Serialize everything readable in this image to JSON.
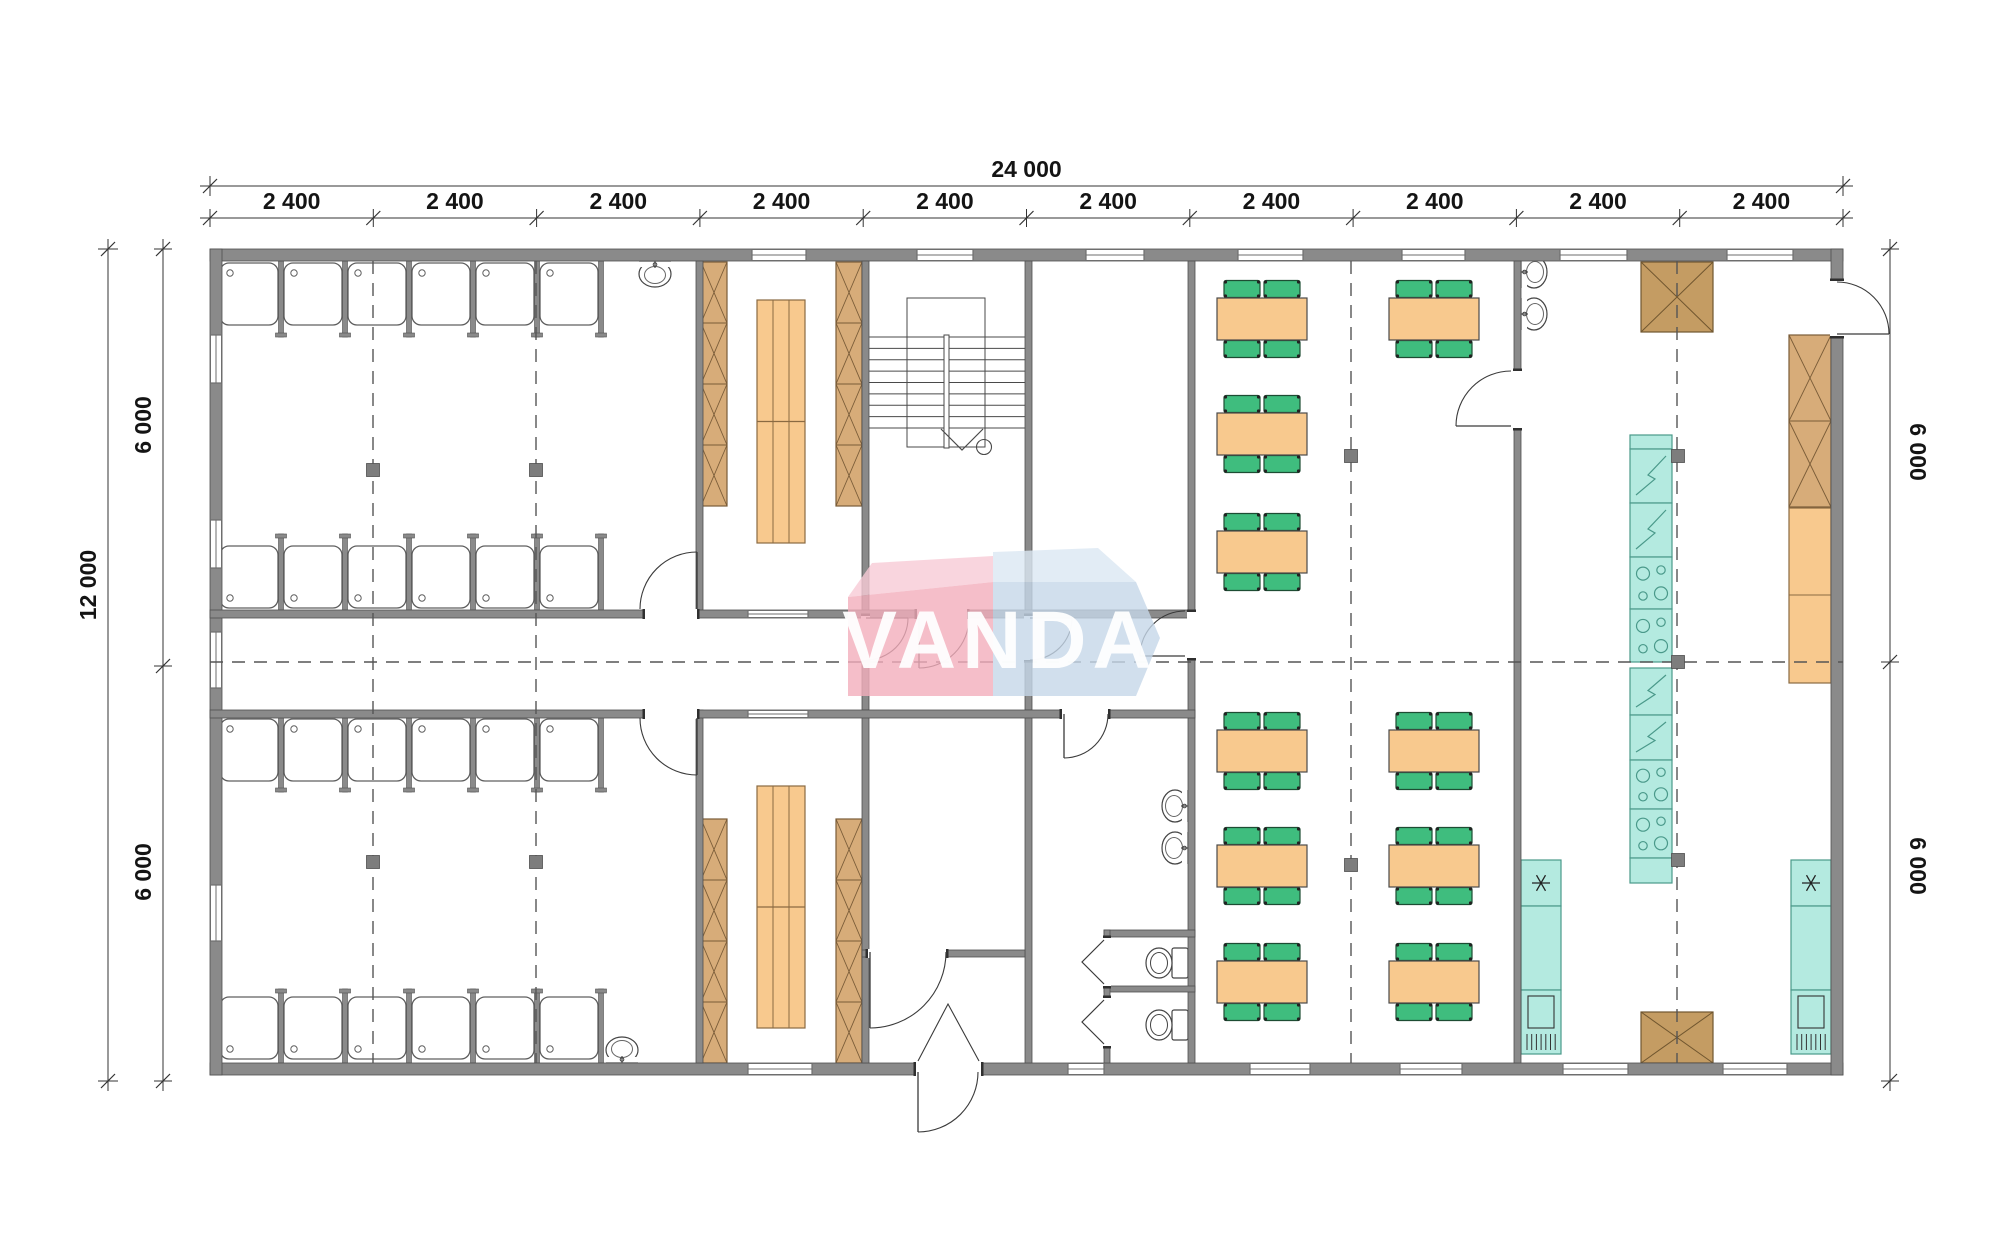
{
  "watermark": {
    "text": "VANDA",
    "pink": "#F2AEBC",
    "pinkFlap": "#F8CBD6",
    "blue": "#C5D7E8",
    "blueFlap": "#DBE7F3",
    "letters": "#FFFFFF"
  },
  "colors": {
    "wall": "#8a8a8a",
    "wallEdge": "#4f4f4f",
    "line": "#3c3c3c",
    "wood": "#D7AC79",
    "woodDark": "#7a5c38",
    "tan": "#C49C63",
    "tanDark": "#70562f",
    "orange": "#F8C98E",
    "orangeEdge": "#8a6a42",
    "green": "#3FBD7E",
    "greenEdge": "#1d4d33",
    "teal": "#B4EAE0",
    "tealEdge": "#4a998a",
    "dash": "#555555",
    "fixture": "#444444",
    "marker": "#7d7d7d",
    "dimText": "#141414",
    "dimLine": "#333333"
  },
  "dims": {
    "top": {
      "total": "24 000",
      "segments": [
        "2 400",
        "2 400",
        "2 400",
        "2 400",
        "2 400",
        "2 400",
        "2 400",
        "2 400",
        "2 400",
        "2 400"
      ],
      "lineY": 186,
      "segY": 218,
      "x0": 210,
      "x1": 1843,
      "totalLabelY": 177,
      "segLabelY": 209
    },
    "left": {
      "total": "12 000",
      "segments": [
        "6 000",
        "6 000"
      ],
      "totalX": 108,
      "segX": 163,
      "y0": 249,
      "y1": 1081,
      "mid": 666,
      "totalLabel": [
        96,
        585
      ],
      "segLabels": [
        [
          151,
          425
        ],
        [
          151,
          872
        ]
      ]
    },
    "right": {
      "segments": [
        "6 000",
        "6 000"
      ],
      "x": 1890,
      "y0": 249,
      "y1": 1081,
      "mid": 662,
      "segLabels": [
        [
          1910,
          452
        ],
        [
          1910,
          866
        ]
      ]
    }
  },
  "plan": {
    "outer": [
      210,
      249,
      1633,
      826
    ],
    "walls": [
      [
        210,
        249,
        1633,
        12
      ],
      [
        210,
        1063,
        1633,
        12
      ],
      [
        210,
        249,
        12,
        826
      ],
      [
        1831,
        249,
        12,
        826
      ],
      [
        696,
        261,
        7,
        349
      ],
      [
        696,
        710,
        7,
        353
      ],
      [
        862,
        261,
        7,
        349
      ],
      [
        862,
        610,
        7,
        100
      ],
      [
        862,
        710,
        7,
        353
      ],
      [
        1025,
        261,
        7,
        349
      ],
      [
        1025,
        610,
        7,
        100
      ],
      [
        1025,
        710,
        7,
        353
      ],
      [
        1188,
        261,
        7,
        802
      ],
      [
        1514,
        261,
        7,
        802
      ],
      [
        210,
        610,
        985,
        8
      ],
      [
        210,
        710,
        985,
        8
      ],
      [
        862,
        950,
        163,
        7
      ],
      [
        1104,
        930,
        91,
        7
      ],
      [
        1104,
        986,
        91,
        6
      ],
      [
        1104,
        930,
        6,
        133
      ]
    ],
    "windows": [
      {
        "x": 752,
        "y": 249,
        "w": 54,
        "t": 12,
        "dir": "h"
      },
      {
        "x": 917,
        "y": 249,
        "w": 56,
        "t": 12,
        "dir": "h"
      },
      {
        "x": 1086,
        "y": 249,
        "w": 58,
        "t": 12,
        "dir": "h"
      },
      {
        "x": 1238,
        "y": 249,
        "w": 65,
        "t": 12,
        "dir": "h"
      },
      {
        "x": 1402,
        "y": 249,
        "w": 63,
        "t": 12,
        "dir": "h"
      },
      {
        "x": 1560,
        "y": 249,
        "w": 67,
        "t": 12,
        "dir": "h"
      },
      {
        "x": 1727,
        "y": 249,
        "w": 66,
        "t": 12,
        "dir": "h"
      },
      {
        "x": 748,
        "y": 1063,
        "w": 64,
        "t": 12,
        "dir": "h"
      },
      {
        "x": 1068,
        "y": 1063,
        "w": 36,
        "t": 12,
        "dir": "h"
      },
      {
        "x": 1250,
        "y": 1063,
        "w": 60,
        "t": 12,
        "dir": "h"
      },
      {
        "x": 1400,
        "y": 1063,
        "w": 62,
        "t": 12,
        "dir": "h"
      },
      {
        "x": 1563,
        "y": 1063,
        "w": 65,
        "t": 12,
        "dir": "h"
      },
      {
        "x": 1723,
        "y": 1063,
        "w": 64,
        "t": 12,
        "dir": "h"
      },
      {
        "x": 210,
        "y": 335,
        "h": 48,
        "t": 12,
        "dir": "v"
      },
      {
        "x": 210,
        "y": 520,
        "h": 48,
        "t": 12,
        "dir": "v"
      },
      {
        "x": 210,
        "y": 632,
        "h": 56,
        "t": 12,
        "dir": "v"
      },
      {
        "x": 210,
        "y": 885,
        "h": 56,
        "t": 12,
        "dir": "v"
      },
      {
        "x": 748,
        "y": 610,
        "w": 60,
        "t": 8,
        "dir": "h"
      },
      {
        "x": 748,
        "y": 710,
        "w": 60,
        "t": 8,
        "dir": "h"
      }
    ],
    "doorGaps": [
      [
        645,
        609,
        52,
        10
      ],
      [
        917,
        609,
        50,
        10
      ],
      [
        645,
        709,
        52,
        10
      ],
      [
        1062,
        709,
        46,
        10
      ],
      [
        861,
        616,
        9,
        44
      ],
      [
        1024,
        616,
        9,
        44
      ],
      [
        1187,
        612,
        9,
        46
      ],
      [
        1513,
        371,
        9,
        57
      ],
      [
        1830,
        281,
        14,
        55
      ],
      [
        916,
        1062,
        65,
        14
      ],
      [
        868,
        949,
        78,
        9
      ],
      [
        1103,
        938,
        8,
        48
      ],
      [
        1103,
        998,
        8,
        48
      ]
    ],
    "doors": [
      {
        "h": [
          697,
          609
        ],
        "r": 57,
        "a0": 180,
        "a1": 90,
        "sweep": 1
      },
      {
        "h": [
          697,
          718
        ],
        "r": 57,
        "a0": 180,
        "a1": 270,
        "sweep": 0
      },
      {
        "h": [
          919,
          618
        ],
        "r": 50,
        "a0": 0,
        "a1": 270,
        "sweep": 1
      },
      {
        "h": [
          866,
          618
        ],
        "r": 42,
        "a0": 270,
        "a1": 0,
        "sweep": 0
      },
      {
        "h": [
          1030,
          618
        ],
        "r": 42,
        "a0": 270,
        "a1": 0,
        "sweep": 0
      },
      {
        "h": [
          1185,
          656
        ],
        "r": 45,
        "a0": 90,
        "a1": 180,
        "sweep": 0
      },
      {
        "h": [
          870,
          952
        ],
        "r": 76,
        "a0": 0,
        "a1": 270,
        "sweep": 1
      },
      {
        "h": [
          918,
          1072
        ],
        "r": 60,
        "a0": 0,
        "a1": 270,
        "sweep": 1
      },
      {
        "h": [
          1064,
          714
        ],
        "r": 44,
        "a0": 0,
        "a1": 270,
        "sweep": 1
      },
      {
        "h": [
          1511,
          426
        ],
        "r": 55,
        "a0": 90,
        "a1": 180,
        "sweep": 0
      },
      {
        "h": [
          1837,
          334
        ],
        "r": 52,
        "a0": 90,
        "a1": 0,
        "sweep": 1
      }
    ],
    "entranceV": [
      [
        918,
        1061
      ],
      [
        948,
        1004
      ],
      [
        979,
        1061
      ]
    ],
    "bifolds": [
      [
        [
          1104,
          940
        ],
        [
          1082,
          962
        ],
        [
          1104,
          984
        ]
      ],
      [
        [
          1104,
          1000
        ],
        [
          1082,
          1022
        ],
        [
          1104,
          1044
        ]
      ]
    ],
    "showerRows": [
      {
        "x": 217,
        "y": 263,
        "n": 6,
        "cw": 64,
        "ch": 62,
        "drain": "top",
        "stubY": 261,
        "stubLen": 76,
        "footEnd": true
      },
      {
        "x": 217,
        "y": 546,
        "n": 6,
        "cw": 64,
        "ch": 62,
        "drain": "bottom",
        "stubY": 534,
        "stubLen": 76,
        "footEnd": false
      },
      {
        "x": 217,
        "y": 719,
        "n": 6,
        "cw": 64,
        "ch": 62,
        "drain": "top",
        "stubY": 718,
        "stubLen": 74,
        "footEnd": true
      },
      {
        "x": 217,
        "y": 997,
        "n": 6,
        "cw": 64,
        "ch": 62,
        "drain": "bottom",
        "stubY": 989,
        "stubLen": 74,
        "footEnd": false
      }
    ],
    "sinks": [
      {
        "x": 655,
        "y": 261,
        "rot": 0
      },
      {
        "x": 622,
        "y": 1063,
        "rot": 180
      },
      {
        "x": 1521,
        "y": 272,
        "rot": -90
      },
      {
        "x": 1521,
        "y": 314,
        "rot": -90
      },
      {
        "x": 1188,
        "y": 806,
        "rot": 90
      },
      {
        "x": 1188,
        "y": 848,
        "rot": 90
      }
    ],
    "toilets": [
      {
        "x": 1188,
        "y": 963
      },
      {
        "x": 1188,
        "y": 1025
      }
    ],
    "wardrobes": [
      [
        701,
        262,
        26,
        244,
        4
      ],
      [
        836,
        262,
        26,
        244,
        4
      ],
      [
        701,
        819,
        26,
        244,
        4
      ],
      [
        836,
        819,
        26,
        244,
        4
      ],
      [
        1789,
        335,
        42,
        172,
        2
      ]
    ],
    "brownTables": [
      [
        1641,
        262,
        72,
        70
      ],
      [
        1641,
        1012,
        72,
        51
      ]
    ],
    "beds": [
      [
        757,
        300,
        48,
        243
      ],
      [
        757,
        786,
        48,
        242
      ]
    ],
    "tables": [
      [
        1262,
        319
      ],
      [
        1434,
        319
      ],
      [
        1262,
        434
      ],
      [
        1262,
        552
      ],
      [
        1262,
        751
      ],
      [
        1434,
        751
      ],
      [
        1262,
        866
      ],
      [
        1434,
        866
      ],
      [
        1262,
        982
      ],
      [
        1434,
        982
      ]
    ],
    "island": {
      "x": 1630,
      "w": 42,
      "units": [
        [
          "cap",
          435,
          14
        ],
        [
          "fridge",
          449,
          54
        ],
        [
          "fridge",
          503,
          54
        ],
        [
          "stove",
          557,
          52
        ],
        [
          "stove",
          609,
          53
        ],
        [
          "fridge",
          668,
          47
        ],
        [
          "fridge",
          715,
          45
        ],
        [
          "stove",
          760,
          49
        ],
        [
          "stove",
          809,
          49
        ],
        [
          "cap",
          858,
          25
        ]
      ]
    },
    "freezerCols": [
      {
        "x": 1521
      },
      {
        "x": 1791
      }
    ],
    "freezerUnits": {
      "w": 40,
      "ast": [
        860,
        46
      ],
      "cab": [
        906,
        84
      ],
      "dw": [
        990,
        64
      ]
    },
    "counter": [
      1789,
      508,
      42,
      175,
      595
    ],
    "stairs": {
      "treads": {
        "x0": 869,
        "x1": 1025,
        "y0": 337,
        "y1": 428,
        "n": 9
      },
      "inner": [
        907,
        298,
        78,
        149
      ],
      "rail": [
        944,
        335,
        5,
        113
      ],
      "arrow": [
        [
          941,
          429
        ],
        [
          962,
          450
        ],
        [
          983,
          429
        ]
      ],
      "circle": [
        984,
        447,
        7.5
      ]
    },
    "markers": [
      [
        373,
        470
      ],
      [
        536,
        470
      ],
      [
        373,
        862
      ],
      [
        536,
        862
      ],
      [
        1351,
        456
      ],
      [
        1351,
        865
      ],
      [
        1678,
        456
      ],
      [
        1678,
        662
      ],
      [
        1678,
        860
      ]
    ],
    "dashV": [
      373,
      536,
      1351,
      1677
    ],
    "dashVy": [
      261,
      1063
    ],
    "dashH": {
      "y": 662,
      "x0": 210,
      "x1": 1843
    }
  }
}
